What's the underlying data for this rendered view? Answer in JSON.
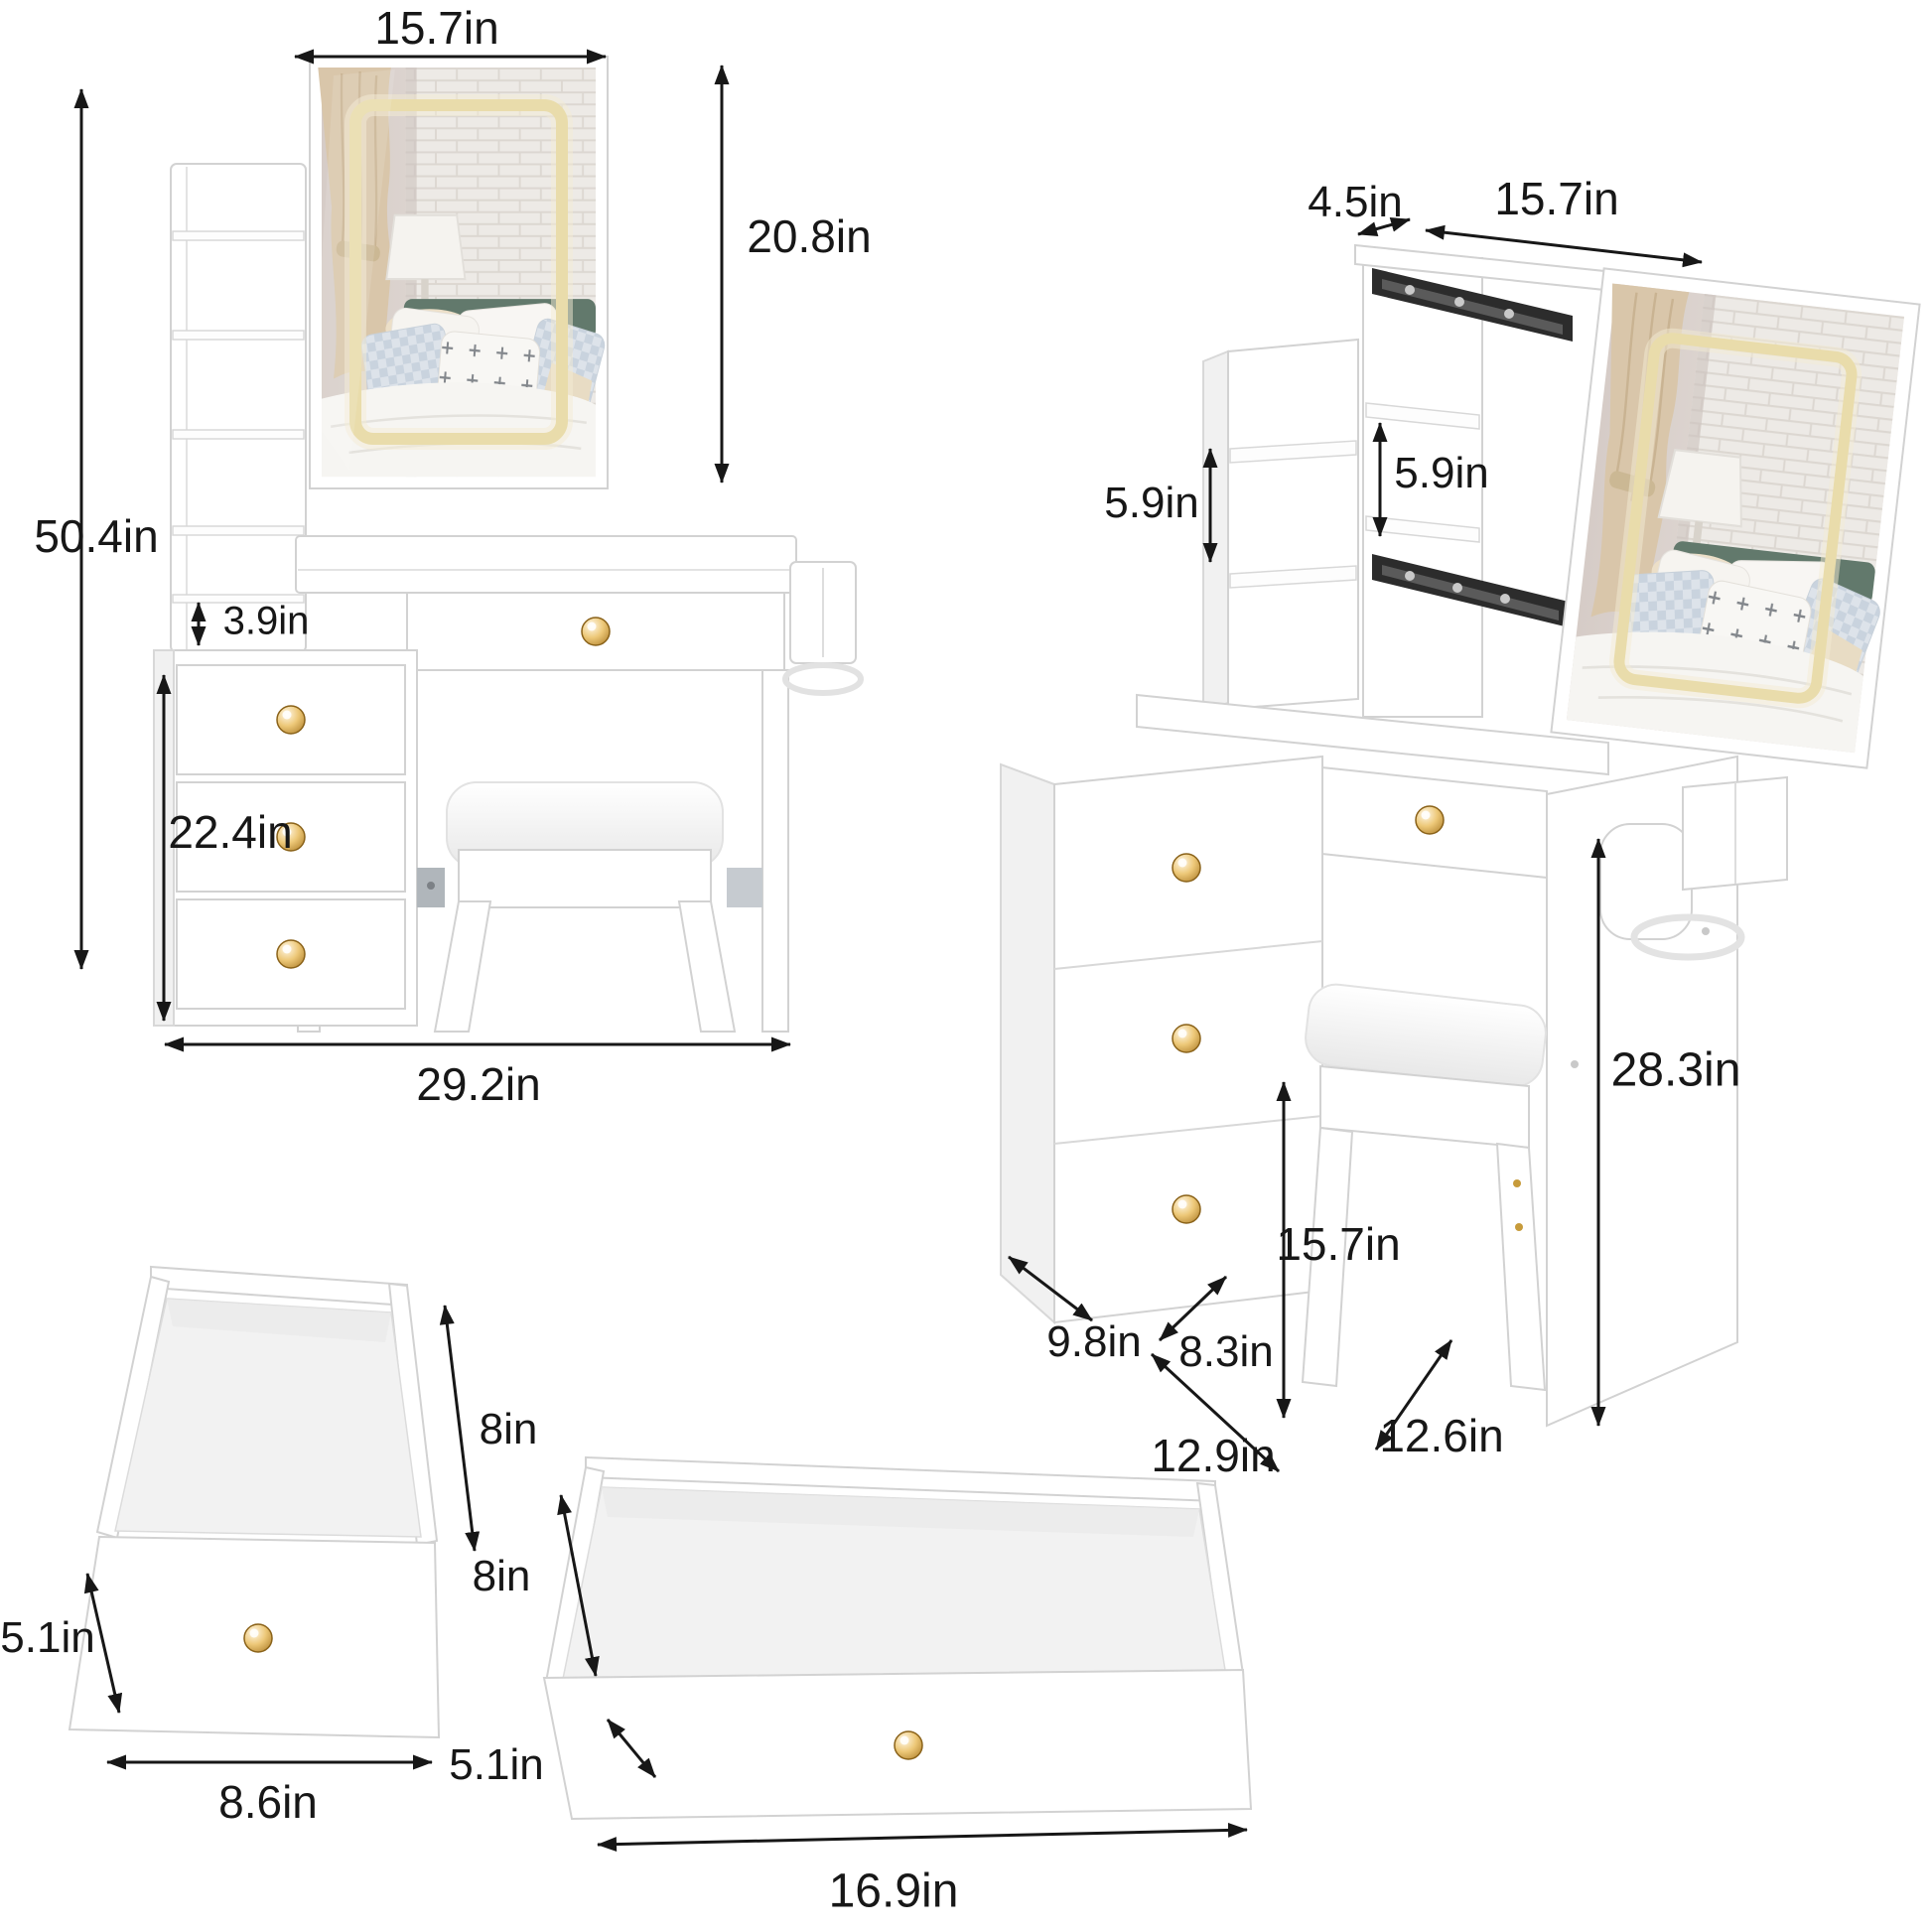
{
  "colors": {
    "led_accent": "#e9dcab",
    "arrow": "#171717",
    "furniture_edge": "#d2d2d2"
  },
  "front_view": {
    "mirror_width": "15.7in",
    "mirror_height": "20.8in",
    "total_height": "50.4in",
    "shelf_gap": "3.9in",
    "cabinet_height": "22.4in",
    "total_width": "29.2in"
  },
  "side_view": {
    "top_depth": "4.5in",
    "top_width": "15.7in",
    "left_shelf_gap": "5.9in",
    "mirror_shelf_gap": "5.9in",
    "desk_height": "28.3in",
    "leg_clearance": "15.7in",
    "cabinet_depth": "9.8in",
    "stool_depth": "8.3in",
    "base_width": "12.9in",
    "panel_depth": "12.6in"
  },
  "small_drawer": {
    "depth": "8in",
    "front_height": "5.1in",
    "width": "8.6in"
  },
  "large_drawer": {
    "depth": "8in",
    "front_height": "5.1in",
    "width": "16.9in"
  }
}
